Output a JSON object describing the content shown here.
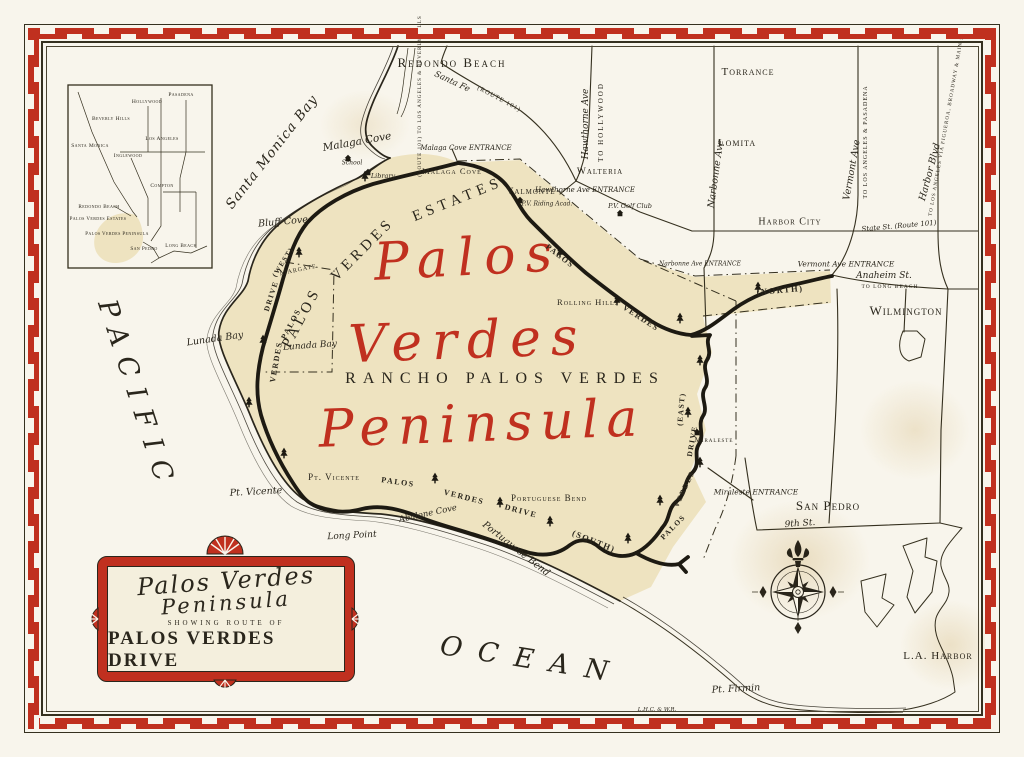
{
  "colors": {
    "paper": "#f8f5ec",
    "ink": "#2a261c",
    "red": "#c0301f",
    "land": "#eee3c0"
  },
  "title_cartouche": {
    "line1": "Palos Verdes",
    "line2": "Peninsula",
    "subtitle": "SHOWING ROUTE OF",
    "main": "PALOS VERDES DRIVE"
  },
  "labels": [
    {
      "n": "redondo-beach",
      "t": "Redondo Beach",
      "x": 452,
      "y": 63,
      "s": 13,
      "f": "caps",
      "ls": 2
    },
    {
      "n": "torrance",
      "t": "Torrance",
      "x": 748,
      "y": 72,
      "s": 11,
      "f": "caps"
    },
    {
      "n": "lomita",
      "t": "Lomita",
      "x": 737,
      "y": 143,
      "s": 11,
      "f": "caps"
    },
    {
      "n": "harbor-city",
      "t": "Harbor City",
      "x": 790,
      "y": 222,
      "s": 10,
      "f": "caps"
    },
    {
      "n": "wilmington",
      "t": "Wilmington",
      "x": 906,
      "y": 311,
      "s": 13,
      "f": "caps",
      "ls": 1
    },
    {
      "n": "walteria",
      "t": "Walteria",
      "x": 600,
      "y": 172,
      "s": 9.5,
      "f": "caps"
    },
    {
      "n": "valmonte",
      "t": "Valmonte",
      "x": 531,
      "y": 192,
      "s": 9.5,
      "f": "caps"
    },
    {
      "n": "san-pedro",
      "t": "San Pedro",
      "x": 828,
      "y": 506,
      "s": 13,
      "f": "caps",
      "ls": 1
    },
    {
      "n": "malaga-cove-town",
      "t": "Malaga Cove",
      "x": 452,
      "y": 171,
      "s": 8.5,
      "f": "caps"
    },
    {
      "n": "malaga-cove-script",
      "t": "Malaga Cove",
      "x": 357,
      "y": 142,
      "s": 10.5,
      "f": "script",
      "r": -10
    },
    {
      "n": "malaga-entrance",
      "t": "Malaga Cove ENTRANCE",
      "x": 466,
      "y": 148,
      "s": 7,
      "f": "script"
    },
    {
      "n": "bluff-cove",
      "t": "Bluff Cove",
      "x": 283,
      "y": 222,
      "s": 9.5,
      "f": "script",
      "r": -5
    },
    {
      "n": "lunada-bay-coast",
      "t": "Lunada Bay",
      "x": 215,
      "y": 339,
      "s": 9.5,
      "f": "script",
      "r": -8
    },
    {
      "n": "lunada-bay",
      "t": "Lunada Bay",
      "x": 310,
      "y": 346,
      "s": 9,
      "f": "script",
      "r": -4
    },
    {
      "n": "margate",
      "t": "Margate",
      "x": 298,
      "y": 269,
      "s": 8,
      "f": "caps",
      "r": -12
    },
    {
      "n": "pt-vicente-caps",
      "t": "Pt. Vicente",
      "x": 334,
      "y": 477,
      "s": 9,
      "f": "caps"
    },
    {
      "n": "pt-vicente-script",
      "t": "Pt. Vicente",
      "x": 256,
      "y": 492,
      "s": 9.5,
      "f": "script",
      "r": -3
    },
    {
      "n": "abalone-cove",
      "t": "Abalone Cove",
      "x": 428,
      "y": 514,
      "s": 8.5,
      "f": "script",
      "r": -12
    },
    {
      "n": "long-point",
      "t": "Long Point",
      "x": 352,
      "y": 536,
      "s": 9,
      "f": "script",
      "r": -3
    },
    {
      "n": "portuguese-bend-coast",
      "t": "Portuguese Bend",
      "x": 516,
      "y": 549,
      "s": 9.5,
      "f": "script",
      "r": 38
    },
    {
      "n": "portuguese-bend",
      "t": "Portuguese Bend",
      "x": 549,
      "y": 498,
      "s": 9,
      "f": "caps"
    },
    {
      "n": "rolling-hills",
      "t": "Rolling Hills",
      "x": 588,
      "y": 302,
      "s": 8.5,
      "f": "caps"
    },
    {
      "n": "miraleste",
      "t": "Miraleste",
      "x": 714,
      "y": 440,
      "s": 7,
      "f": "caps"
    },
    {
      "n": "miraleste-entrance",
      "t": "Miraleste ENTRANCE",
      "x": 756,
      "y": 492,
      "s": 7.5,
      "f": "script"
    },
    {
      "n": "hawthorne-entrance",
      "t": "Hawthorne Ave ENTRANCE",
      "x": 585,
      "y": 190,
      "s": 7,
      "f": "script"
    },
    {
      "n": "narbonne-entrance",
      "t": "Narbonne Ave ENTRANCE",
      "x": 700,
      "y": 264,
      "s": 6,
      "f": "script"
    },
    {
      "n": "vermont-entrance",
      "t": "Vermont Ave ENTRANCE",
      "x": 846,
      "y": 264,
      "s": 7.5,
      "f": "script"
    },
    {
      "n": "pv-golf-club",
      "t": "P.V. Golf Club",
      "x": 630,
      "y": 206,
      "s": 6.5,
      "f": "script"
    },
    {
      "n": "pv-riding-acad",
      "t": "P.V. Riding Acad.",
      "x": 547,
      "y": 204,
      "s": 6,
      "f": "script"
    },
    {
      "n": "library",
      "t": "Library",
      "x": 383,
      "y": 176,
      "s": 6.5,
      "f": "script"
    },
    {
      "n": "school",
      "t": "School",
      "x": 352,
      "y": 163,
      "s": 6,
      "f": "script"
    },
    {
      "n": "anaheim-st",
      "t": "Anaheim St.",
      "x": 884,
      "y": 276,
      "s": 9,
      "f": "script"
    },
    {
      "n": "anaheim-to",
      "t": "TO LONG BEACH",
      "x": 890,
      "y": 287,
      "s": 5.5,
      "f": "caps"
    },
    {
      "n": "state-st",
      "t": "State St. (Route 101)",
      "x": 899,
      "y": 226,
      "s": 7,
      "f": "script",
      "r": -5
    },
    {
      "n": "ninth-st",
      "t": "9th St.",
      "x": 800,
      "y": 524,
      "s": 9,
      "f": "script",
      "r": -4
    },
    {
      "n": "pt-firmin",
      "t": "Pt. Firmin",
      "x": 736,
      "y": 689,
      "s": 9.5,
      "f": "script",
      "r": -3
    },
    {
      "n": "la-harbor",
      "t": "L.A. Harbor",
      "x": 938,
      "y": 656,
      "s": 11,
      "f": "caps",
      "ls": 1
    },
    {
      "n": "hawthorne-ave",
      "t": "Hawthorne Ave",
      "x": 586,
      "y": 124,
      "s": 9,
      "f": "script",
      "r": -90
    },
    {
      "n": "to-hollywood",
      "t": "TO HOLLYWOOD",
      "x": 601,
      "y": 122,
      "s": 7,
      "f": "caps",
      "r": -90,
      "ls": 2
    },
    {
      "n": "narbonne-ave",
      "t": "Narbonne Ave",
      "x": 716,
      "y": 174,
      "s": 9.5,
      "f": "script",
      "r": -82
    },
    {
      "n": "vermont-ave",
      "t": "Vermont Ave",
      "x": 852,
      "y": 170,
      "s": 9.5,
      "f": "script",
      "r": -80
    },
    {
      "n": "vermont-to",
      "t": "TO LOS ANGELES & PASADENA",
      "x": 866,
      "y": 142,
      "s": 6,
      "f": "caps",
      "r": -90,
      "ls": 1
    },
    {
      "n": "harbor-blvd",
      "t": "Harbor Blvd",
      "x": 930,
      "y": 172,
      "s": 9.5,
      "f": "script",
      "r": -75
    },
    {
      "n": "harbor-to",
      "t": "TO LOS ANGELES VIA FIGUEROA, BROADWAY & MAIN STS",
      "x": 947,
      "y": 122,
      "s": 5.2,
      "f": "caps",
      "r": -80
    },
    {
      "n": "route101-to",
      "t": "(ROUTE 101) TO LOS ANGELES & BEVERLY HILLS",
      "x": 420,
      "y": 96,
      "s": 5.2,
      "f": "caps",
      "r": -90
    },
    {
      "n": "santa-fe",
      "t": "Santa Fe",
      "x": 452,
      "y": 82,
      "s": 8.5,
      "f": "script",
      "r": 25
    },
    {
      "n": "route101",
      "t": "(ROUTE 101)",
      "x": 499,
      "y": 99,
      "s": 6.5,
      "f": "caps",
      "r": 28
    },
    {
      "n": "santa-monica-bay",
      "t": "Santa Monica Bay",
      "x": 272,
      "y": 152,
      "s": 13.5,
      "f": "script",
      "r": -52,
      "ls": 1
    },
    {
      "n": "pacific",
      "t": "PACIFIC",
      "x": 137,
      "y": 396,
      "s": 27,
      "f": "script",
      "r": 72,
      "ls": 12
    },
    {
      "n": "ocean",
      "t": "OCEAN",
      "x": 532,
      "y": 660,
      "s": 27,
      "f": "script",
      "r": 9,
      "ls": 16
    },
    {
      "n": "big-palos",
      "t": "Palos",
      "x": 468,
      "y": 258,
      "s": 52,
      "f": "redbig",
      "r": -3,
      "ls": 10
    },
    {
      "n": "big-verdes",
      "t": "Verdes",
      "x": 468,
      "y": 341,
      "s": 52,
      "f": "redbig",
      "r": -2,
      "ls": 10
    },
    {
      "n": "big-peninsula",
      "t": "Peninsula",
      "x": 482,
      "y": 424,
      "s": 52,
      "f": "redbig",
      "r": -2,
      "ls": 8
    },
    {
      "n": "rancho-palos-verdes",
      "t": "RANCHO PALOS VERDES",
      "x": 505,
      "y": 379,
      "s": 16,
      "f": "caps",
      "ls": 7
    },
    {
      "n": "pve-palos",
      "t": "PALOS",
      "x": 302,
      "y": 318,
      "s": 15,
      "f": "caps",
      "r": -62,
      "ls": 4
    },
    {
      "n": "pve-verdes",
      "t": "VERDES",
      "x": 363,
      "y": 250,
      "s": 15,
      "f": "caps",
      "r": -45,
      "ls": 4
    },
    {
      "n": "pve-estates",
      "t": "ESTATES",
      "x": 458,
      "y": 200,
      "s": 15,
      "f": "caps",
      "r": -22,
      "ls": 5
    },
    {
      "n": "drive-west-tag",
      "t": "(WEST)",
      "x": 283,
      "y": 262,
      "s": 7,
      "f": "boldcaps",
      "r": -58
    },
    {
      "n": "drive-west-drive",
      "t": "DRIVE",
      "x": 271,
      "y": 296,
      "s": 7.5,
      "f": "boldcaps",
      "r": -72
    },
    {
      "n": "drive-west-palos",
      "t": "PALOS",
      "x": 291,
      "y": 324,
      "s": 8,
      "f": "boldcaps",
      "r": -62
    },
    {
      "n": "drive-west-verdes",
      "t": "VERDES",
      "x": 276,
      "y": 362,
      "s": 8,
      "f": "boldcaps",
      "r": -80
    },
    {
      "n": "drive-north-palos",
      "t": "PALOS",
      "x": 560,
      "y": 256,
      "s": 8,
      "f": "boldcaps",
      "r": 38
    },
    {
      "n": "drive-north-verdes",
      "t": "VERDES",
      "x": 641,
      "y": 318,
      "s": 8,
      "f": "boldcaps",
      "r": 33
    },
    {
      "n": "drive-north-tag",
      "t": "(NORTH)",
      "x": 780,
      "y": 290,
      "s": 8.5,
      "f": "boldcaps",
      "r": -5
    },
    {
      "n": "drive-south-palos",
      "t": "PALOS",
      "x": 398,
      "y": 482,
      "s": 8,
      "f": "boldcaps",
      "r": 8
    },
    {
      "n": "drive-south-verdes",
      "t": "VERDES",
      "x": 464,
      "y": 497,
      "s": 8,
      "f": "boldcaps",
      "r": 14
    },
    {
      "n": "drive-south-drive",
      "t": "DRIVE",
      "x": 521,
      "y": 511,
      "s": 8,
      "f": "boldcaps",
      "r": 15
    },
    {
      "n": "drive-south-tag",
      "t": "(SOUTH)",
      "x": 594,
      "y": 541,
      "s": 8.5,
      "f": "boldcaps",
      "r": 22
    },
    {
      "n": "drive-east-tag",
      "t": "(EAST)",
      "x": 681,
      "y": 409,
      "s": 7.5,
      "f": "boldcaps",
      "r": -85
    },
    {
      "n": "drive-east-drive",
      "t": "DRIVE",
      "x": 692,
      "y": 441,
      "s": 7.5,
      "f": "boldcaps",
      "r": -80
    },
    {
      "n": "drive-east-verdes",
      "t": "VERDES",
      "x": 684,
      "y": 489,
      "s": 7.5,
      "f": "boldcaps",
      "r": -65
    },
    {
      "n": "drive-east-palos",
      "t": "PALOS",
      "x": 673,
      "y": 527,
      "s": 7.5,
      "f": "boldcaps",
      "r": -45
    },
    {
      "n": "credit",
      "t": "L.H.C. & W.R.",
      "x": 657,
      "y": 710,
      "s": 5.5,
      "f": "script"
    },
    {
      "n": "inset-pasadena",
      "t": "Pasadena",
      "x": 181,
      "y": 95,
      "s": 5.5,
      "f": "tinycaps"
    },
    {
      "n": "inset-hollywood",
      "t": "Hollywood",
      "x": 147,
      "y": 102,
      "s": 5.5,
      "f": "tinycaps"
    },
    {
      "n": "inset-beverly-hills",
      "t": "Beverly Hills",
      "x": 111,
      "y": 119,
      "s": 5.5,
      "f": "tinycaps"
    },
    {
      "n": "inset-santa-monica",
      "t": "Santa Monica",
      "x": 90,
      "y": 146,
      "s": 5.5,
      "f": "tinycaps"
    },
    {
      "n": "inset-los-angeles",
      "t": "Los Angeles",
      "x": 162,
      "y": 139,
      "s": 5.5,
      "f": "tinycaps"
    },
    {
      "n": "inset-inglewood",
      "t": "Inglewood",
      "x": 128,
      "y": 156,
      "s": 5.5,
      "f": "tinycaps"
    },
    {
      "n": "inset-compton",
      "t": "Compton",
      "x": 162,
      "y": 186,
      "s": 5.5,
      "f": "tinycaps"
    },
    {
      "n": "inset-redondo-beach",
      "t": "Redondo Beach",
      "x": 99,
      "y": 207,
      "s": 5.2,
      "f": "tinycaps"
    },
    {
      "n": "inset-pv-estates",
      "t": "Palos Verdes Estates",
      "x": 98,
      "y": 219,
      "s": 5,
      "f": "tinycaps"
    },
    {
      "n": "inset-pv-peninsula",
      "t": "Palos Verdes Peninsula",
      "x": 117,
      "y": 234,
      "s": 5,
      "f": "tinycaps"
    },
    {
      "n": "inset-san-pedro",
      "t": "San Pedro",
      "x": 144,
      "y": 249,
      "s": 5.2,
      "f": "tinycaps"
    },
    {
      "n": "inset-long-beach",
      "t": "Long Beach",
      "x": 181,
      "y": 246,
      "s": 5.2,
      "f": "tinycaps"
    }
  ],
  "icons": {
    "trees": [
      [
        365,
        176
      ],
      [
        299,
        252
      ],
      [
        263,
        340
      ],
      [
        249,
        402
      ],
      [
        284,
        453
      ],
      [
        560,
        252
      ],
      [
        617,
        300
      ],
      [
        680,
        318
      ],
      [
        758,
        287
      ],
      [
        700,
        360
      ],
      [
        688,
        412
      ],
      [
        700,
        462
      ],
      [
        435,
        478
      ],
      [
        500,
        502
      ],
      [
        550,
        521
      ],
      [
        628,
        538
      ],
      [
        660,
        500
      ]
    ],
    "houses": [
      [
        348,
        158
      ],
      [
        368,
        172
      ],
      [
        520,
        200
      ],
      [
        620,
        213
      ],
      [
        697,
        432
      ]
    ]
  }
}
